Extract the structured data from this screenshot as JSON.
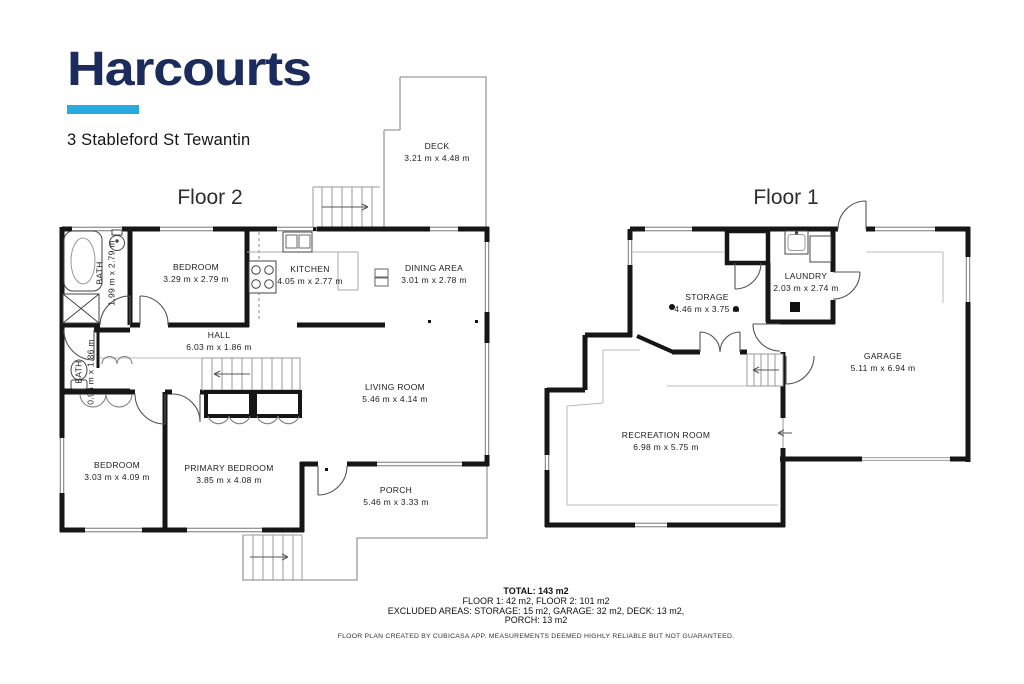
{
  "header": {
    "logo_text": "Harcourts",
    "address": "3 Stableford St Tewantin"
  },
  "brand": {
    "navy": "#1b2b5c",
    "cyan": "#29abe2",
    "wall_color": "#161616"
  },
  "floor2": {
    "title": "Floor 2",
    "rooms": {
      "deck": {
        "name": "DECK",
        "dims": "3.21 m x 4.48 m"
      },
      "bath_upper": {
        "name": "BATH",
        "dims": "1.99 m x 2.79 m"
      },
      "bedroom_upper": {
        "name": "BEDROOM",
        "dims": "3.29 m x 2.79 m"
      },
      "kitchen": {
        "name": "KITCHEN",
        "dims": "4.05 m x 2.77 m"
      },
      "dining": {
        "name": "DINING AREA",
        "dims": "3.01 m x 2.78 m"
      },
      "hall": {
        "name": "HALL",
        "dims": "6.03 m x 1.86 m"
      },
      "living": {
        "name": "LIVING ROOM",
        "dims": "5.46 m x 4.14 m"
      },
      "bath_lower": {
        "name": "BATH",
        "dims": "0.96 m x 1.86 m"
      },
      "bedroom_lower": {
        "name": "BEDROOM",
        "dims": "3.03 m x 4.09 m"
      },
      "primary_bedroom": {
        "name": "PRIMARY BEDROOM",
        "dims": "3.85 m x 4.08 m"
      },
      "porch": {
        "name": "PORCH",
        "dims": "5.46 m x 3.33 m"
      }
    }
  },
  "floor1": {
    "title": "Floor 1",
    "rooms": {
      "storage": {
        "name": "STORAGE",
        "dims": "4.46 m x 3.75 m"
      },
      "laundry": {
        "name": "LAUNDRY",
        "dims": "2.03 m x 2.74 m"
      },
      "garage": {
        "name": "GARAGE",
        "dims": "5.11 m x 6.94 m"
      },
      "recreation": {
        "name": "RECREATION ROOM",
        "dims": "6.98 m x 5.75 m"
      }
    }
  },
  "summary": {
    "total": "TOTAL: 143 m2",
    "floors": "FLOOR 1: 42 m2, FLOOR 2: 101 m2",
    "excluded_1": "EXCLUDED AREAS: STORAGE: 15 m2, GARAGE: 32 m2, DECK: 13 m2,",
    "excluded_2": "PORCH: 13 m2",
    "disclaimer": "FLOOR PLAN CREATED BY CUBICASA APP. MEASUREMENTS DEEMED HIGHLY RELIABLE BUT NOT GUARANTEED."
  }
}
